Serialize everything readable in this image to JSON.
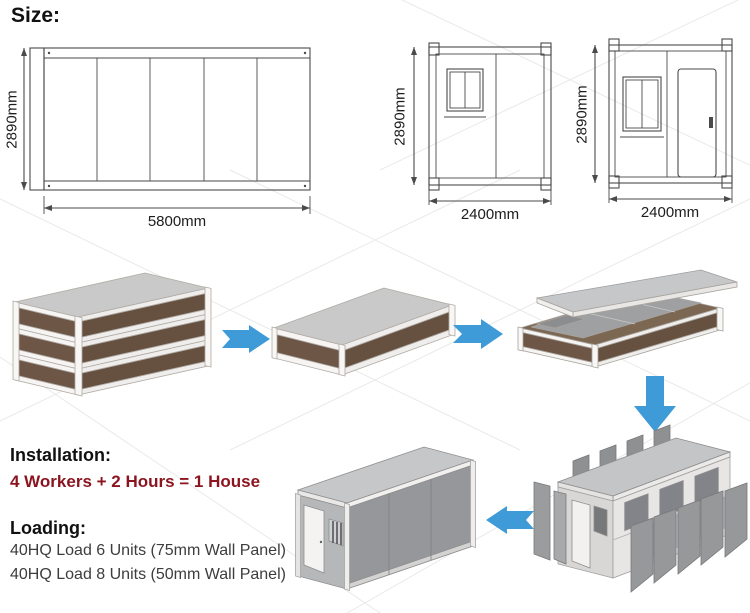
{
  "size_section": {
    "title": "Size:",
    "drawings": [
      {
        "view": "side-elevation",
        "height_label": "2890mm",
        "width_label": "5800mm"
      },
      {
        "view": "end-elevation-window",
        "height_label": "2890mm",
        "width_label": "2400mm"
      },
      {
        "view": "end-elevation-door",
        "height_label": "2890mm",
        "width_label": "2400mm"
      }
    ]
  },
  "process": {
    "steps": [
      "stacked-flat-packs",
      "single-flat-pack",
      "unfolding-flat-pack",
      "panel-assembly",
      "finished-container-house"
    ],
    "arrow_icons": [
      "arrow-right",
      "arrow-right",
      "arrow-down",
      "arrow-left"
    ]
  },
  "installation": {
    "title": "Installation:",
    "formula": "4 Workers + 2 Hours = 1 House"
  },
  "loading": {
    "title": "Loading:",
    "line1": "40HQ Load 6 Units (75mm Wall Panel)",
    "line2": "40HQ Load 8 Units (50mm Wall Panel)"
  },
  "colors": {
    "arrow_blue": "#3f9bd7",
    "accent_red": "#8b141f",
    "panel_brown": "#6e5646",
    "frame_white": "#f5f4f2",
    "wall_gray": "#97989b",
    "roof_gray": "#c7c8ca",
    "drawing_line": "#4a4a4a"
  }
}
